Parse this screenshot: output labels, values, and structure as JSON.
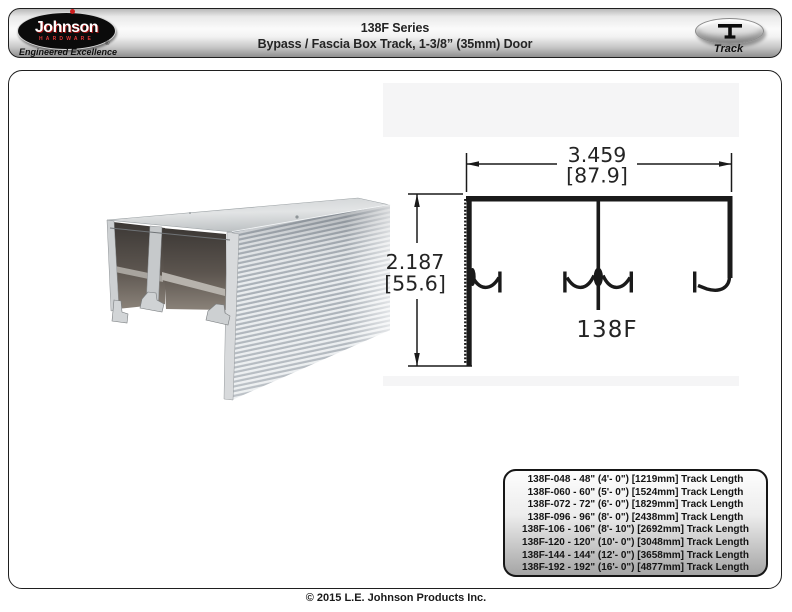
{
  "header": {
    "logo": {
      "brand": "Johnson",
      "hardware": "HARDWARE",
      "registered": "®",
      "tagline": "Engineered Excellence"
    },
    "title_line1": "138F Series",
    "title_line2": "Bypass / Fascia Box Track, 1-3/8” (35mm) Door",
    "track_badge": {
      "label": "Track",
      "icon": "track-profile-icon"
    }
  },
  "diagram": {
    "width_in": "3.459",
    "width_mm": "[87.9]",
    "height_in": "2.187",
    "height_mm": "[55.6]",
    "part_label": "138F"
  },
  "photo": {
    "description": "aluminum-bypass-box-track-extrusion"
  },
  "parts_table": {
    "rows": [
      "138F-048 - 48\" (4'- 0\") [1219mm] Track Length",
      "138F-060 - 60\" (5'- 0\") [1524mm] Track Length",
      "138F-072 - 72\" (6'- 0\") [1829mm] Track Length",
      "138F-096 - 96\" (8'- 0\") [2438mm] Track Length",
      "138F-106 - 106\" (8'- 10\") [2692mm] Track Length",
      "138F-120 - 120\" (10'- 0\") [3048mm] Track Length",
      "138F-144 - 144\" (12'- 0\") [3658mm] Track Length",
      "138F-192 - 192\" (16'- 0\") [4877mm] Track Length"
    ]
  },
  "footer": {
    "copyright": "© 2015 L.E. Johnson Products Inc."
  },
  "colors": {
    "line_color": "#1a1a1a",
    "logo_red": "#cc1f1f",
    "header_gradient_top": "#b9b9b9",
    "header_gradient_bottom": "#8f8f8f",
    "table_gradient_bottom": "#a5a5a5",
    "aluminum_light": "#e9ecee",
    "aluminum_dark": "#adb3ba",
    "cavity_dark": "#3c3835"
  }
}
